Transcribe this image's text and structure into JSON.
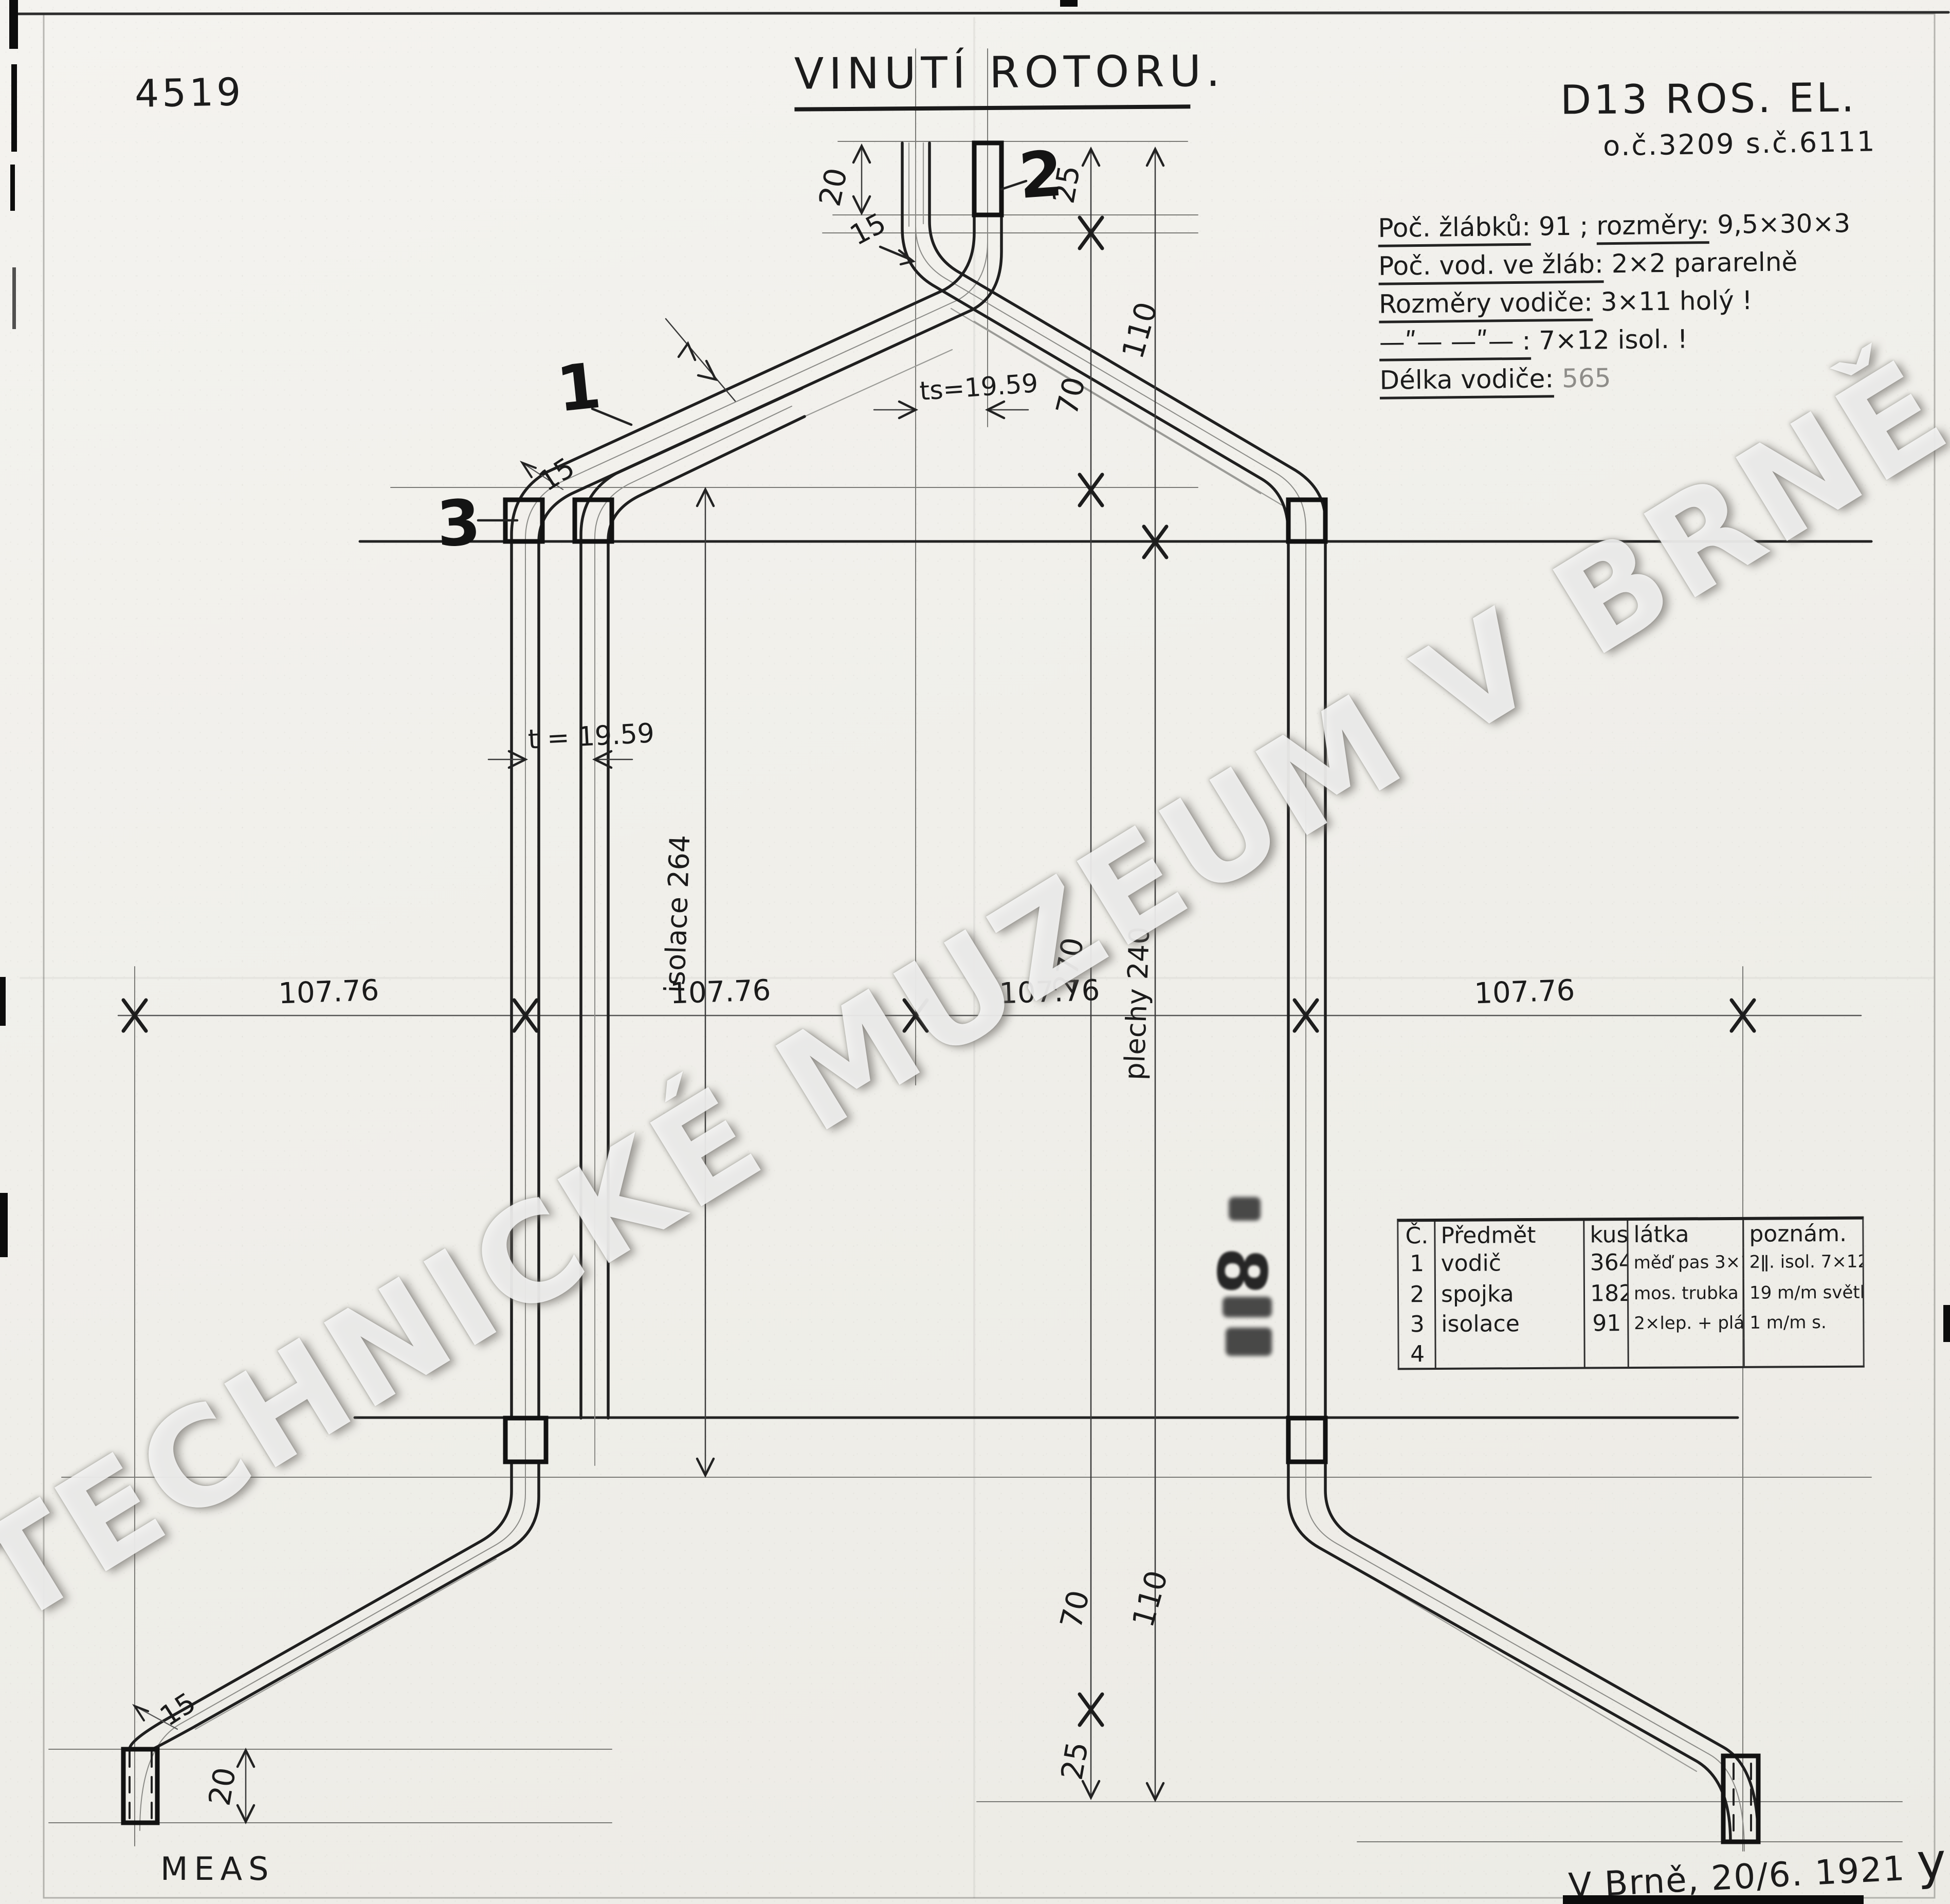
{
  "doc": {
    "drawing_number": "4519",
    "title": "VINUTÍ ROTORU.",
    "project_code": "D13 ROS. EL.",
    "order_info": "o.č.3209   s.č.6111",
    "place_date": "V Brně, 20/6. 1921",
    "signature": "y",
    "bottom_left_mark": "MEAS",
    "watermark": "TECHNICKÉ MUZEUM V BRNĚ",
    "stamp": "8"
  },
  "notes": {
    "n1a": "Poč. žlábků:",
    "n1b": " 91 ; ",
    "n1c": "rozměry:",
    "n1d": " 9,5×30×3",
    "n2a": "Poč. vod. ve žláb:",
    "n2b": "  2×2 pararelně",
    "n3a": "Rozměry vodiče:",
    "n3b": " 3×11 holý !",
    "n4a": "—ʺ—   —ʺ— :",
    "n4b": " 7×12 isol. !",
    "n5a": "Délka vodiče:",
    "n5b": "  565"
  },
  "parts_table": {
    "headers": [
      "Č.",
      "Předmět",
      "kusů",
      "látka",
      "poznám."
    ],
    "rows": [
      [
        "1",
        "vodič",
        "364",
        "měď pas 3×11",
        "2ǁ. isol. 7×12"
      ],
      [
        "2",
        "spojka",
        "182",
        "mos. trubka",
        "19 m/m světl. 1 m/m s."
      ],
      [
        "3",
        "isolace",
        "91",
        "2×lep. + plát.",
        "1 m/m s."
      ],
      [
        "4",
        "",
        "",
        "",
        ""
      ]
    ]
  },
  "dims": {
    "stub_top": "20",
    "gap_top": "25",
    "v110_top": "110",
    "v70_top": "70",
    "pitch_top": "ts=19.59",
    "pitch_mid": "t = 19.59",
    "r15_top": "15",
    "r15_left": "15",
    "r15_bottom": "15",
    "iso": "isolace 264",
    "mid270": "270",
    "stack": "plechy 240",
    "spans": [
      "107.76",
      "107.76",
      "107.76",
      "107.76"
    ],
    "v70_bot": "70",
    "v110_bot": "110",
    "gap_bot": "25",
    "stub_bot": "20"
  },
  "callouts": {
    "c1": "1",
    "c2": "2",
    "c3": "3"
  }
}
